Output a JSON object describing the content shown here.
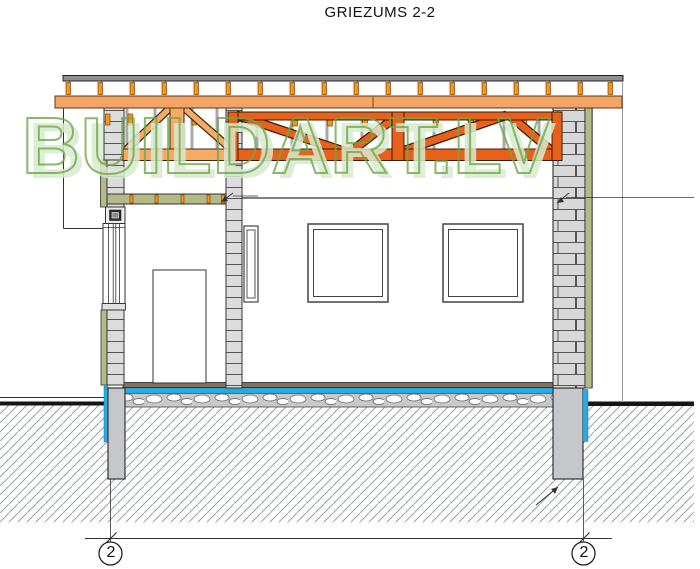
{
  "drawing": {
    "title": "GRIEZUMS 2-2",
    "watermark": "BUILDART.LV",
    "type_note": "building cross-section"
  },
  "grid_markers": {
    "left_label": "2",
    "right_label": "2"
  },
  "colors": {
    "truss_dark": "#E8611A",
    "truss_light": "#F5AB66",
    "roof_beam": "#F2A564",
    "batten_orange": "#F7941D",
    "insulation_olive": "#B3BA88",
    "slab_blue": "#29ABE2",
    "floor_brown": "#837260",
    "masonry_gray": "#DCDCDC",
    "pier_gray": "#C5C7CB",
    "sheathing_gray": "#8E9092",
    "watermark_green": "#6DA846",
    "watermark_fill": "#D9EAD0",
    "hatch_gray": "#9AA0A4"
  }
}
